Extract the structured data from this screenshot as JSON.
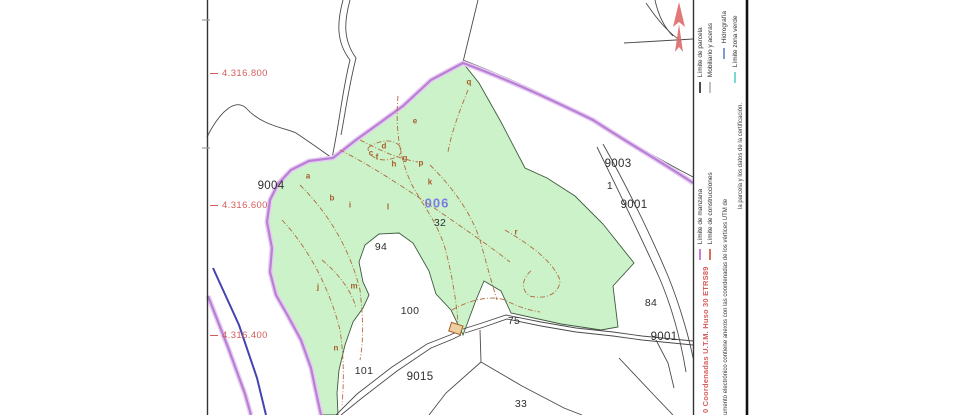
{
  "legend": {
    "items": [
      {
        "label": "Límite de manzana",
        "color": "#c87fd6"
      },
      {
        "label": "Límite de construcciones",
        "color": "#d9715a"
      },
      {
        "label": "Límite de parcela",
        "color": "#4a4a4a"
      },
      {
        "label": "Mobiliario y aceras",
        "color": "#c2c2c2"
      },
      {
        "label": "Hidrografía",
        "color": "#7e9bd8"
      },
      {
        "label": "Límite zona verde",
        "color": "#7fd8cf"
      }
    ],
    "coordinates_note": "0 Coordenadas U.T.M. Huso 30 ETRS89",
    "disclaimer_line1": "umento electrónico contiene anexos con las coordenadas de los vértices UTM de",
    "disclaimer_line2": "la parcela y los datos de la certificación."
  },
  "map": {
    "coordinate_labels": [
      {
        "text": "4.316.800"
      },
      {
        "text": "4.316.600"
      },
      {
        "text": "4.316.400"
      }
    ],
    "highlight_parcel": {
      "text": "006"
    },
    "parcel_labels": [
      {
        "text": "9004"
      },
      {
        "text": "9003"
      },
      {
        "text": "1"
      },
      {
        "text": "9001"
      },
      {
        "text": "32"
      },
      {
        "text": "94"
      },
      {
        "text": "100"
      },
      {
        "text": "75"
      },
      {
        "text": "84"
      },
      {
        "text": "9001"
      },
      {
        "text": "101"
      },
      {
        "text": "9015"
      },
      {
        "text": "33"
      }
    ],
    "subparcel_letters": [
      {
        "text": "a"
      },
      {
        "text": "b"
      },
      {
        "text": "c"
      },
      {
        "text": "d"
      },
      {
        "text": "e"
      },
      {
        "text": "f"
      },
      {
        "text": "g"
      },
      {
        "text": "h"
      },
      {
        "text": "i"
      },
      {
        "text": "j"
      },
      {
        "text": "k"
      },
      {
        "text": "l"
      },
      {
        "text": "m"
      },
      {
        "text": "n"
      },
      {
        "text": "p"
      },
      {
        "text": "q"
      },
      {
        "text": "r"
      }
    ]
  },
  "colors": {
    "green_zone_fill": "#cbf2c8",
    "manzana_magenta": "#b97fd4",
    "hydro_blue": "#4444b0",
    "construction_brown": "#b26a3f",
    "grid_red": "#d65c5c"
  }
}
